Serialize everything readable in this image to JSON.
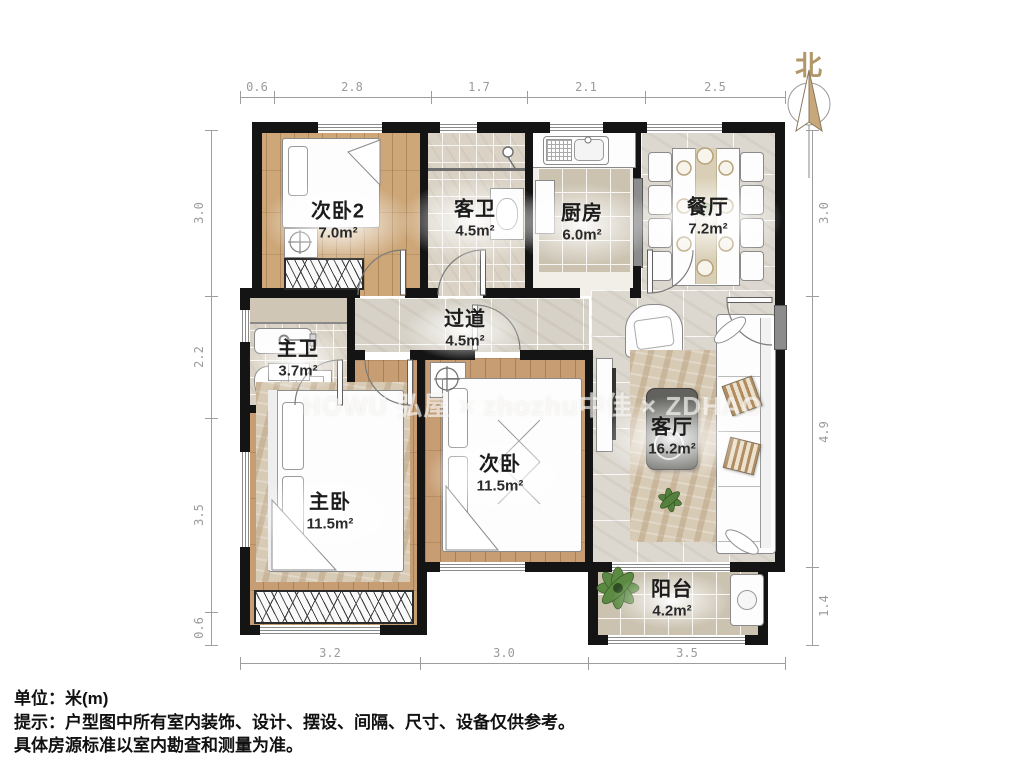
{
  "compass": {
    "label": "北"
  },
  "watermark": {
    "text": "HOWU 弘屋 × zhozhu中佳 × ZDHAO"
  },
  "rooms": [
    {
      "name": "次卧2",
      "area": "7.0m²"
    },
    {
      "name": "客卫",
      "area": "4.5m²"
    },
    {
      "name": "厨房",
      "area": "6.0m²"
    },
    {
      "name": "餐厅",
      "area": "7.2m²"
    },
    {
      "name": "过道",
      "area": "4.5m²"
    },
    {
      "name": "主卫",
      "area": "3.7m²"
    },
    {
      "name": "主卧",
      "area": "11.5m²"
    },
    {
      "name": "次卧",
      "area": "11.5m²"
    },
    {
      "name": "客厅",
      "area": "16.2m²"
    },
    {
      "name": "阳台",
      "area": "4.2m²"
    }
  ],
  "dims": {
    "top": [
      "0.6",
      "2.8",
      "1.7",
      "2.1",
      "2.5"
    ],
    "bottom": [
      "3.2",
      "3.0",
      "3.5"
    ],
    "left": [
      "3.0",
      "2.2",
      "3.5",
      "0.6"
    ],
    "right": [
      "3.0",
      "4.9",
      "1.4"
    ]
  },
  "notes": {
    "unit": "单位：米(m)",
    "tip": "提示：户型图中所有室内装饰、设计、摆设、间隔、尺寸、设备仅供参考。",
    "tip2": "具体房源标准以室内勘查和测量为准。"
  },
  "colors": {
    "wall": "#141414",
    "wood_floor": "#c79d73",
    "tile_floor": "#d9d2c5",
    "marble_floor": "#dcd8d0",
    "compass_accent": "#b2976b",
    "dim_text": "#9b9b9b"
  }
}
